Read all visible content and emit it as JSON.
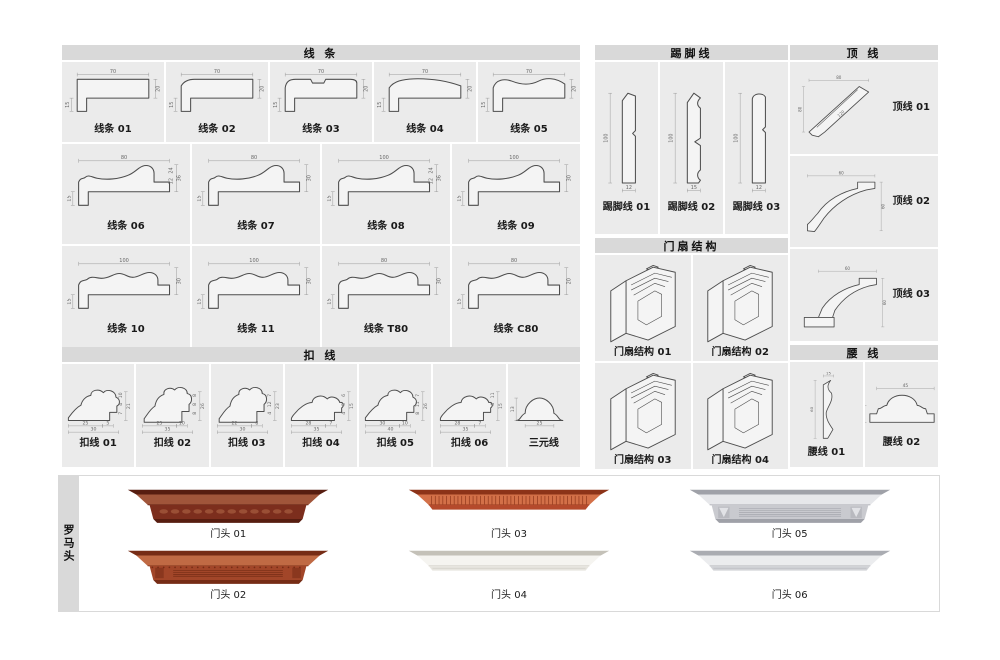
{
  "page": {
    "width": 1000,
    "height": 660,
    "background": "#ffffff"
  },
  "colors": {
    "header_bg": "#d9d9d9",
    "panel_bg": "#ebebeb",
    "profile_outline": "#4d4d4d",
    "dim_line": "#999999",
    "dim_text": "#666666",
    "label_text": "#1a1a1a"
  },
  "sections": {
    "xiantiao": {
      "title": "线  条",
      "rows": [
        {
          "items": [
            {
              "label": "线条 01",
              "shape": "flat",
              "dims": {
                "top": "70",
                "right": "20",
                "left": "15"
              }
            },
            {
              "label": "线条 02",
              "shape": "slant",
              "dims": {
                "top": "70",
                "right": "20",
                "left": "15"
              }
            },
            {
              "label": "线条 03",
              "shape": "groove",
              "dims": {
                "top": "70",
                "right": "20",
                "left": "15"
              }
            },
            {
              "label": "线条 04",
              "shape": "arch",
              "dims": {
                "top": "70",
                "right": "20",
                "left": "15"
              }
            },
            {
              "label": "线条 05",
              "shape": "wave",
              "dims": {
                "top": "70",
                "right": "20",
                "left": "15"
              }
            }
          ]
        },
        {
          "items": [
            {
              "label": "线条 06",
              "shape": "ogee",
              "dims": {
                "top": "80",
                "right": "36",
                "right_inner": [
                  "24",
                  "12"
                ],
                "left": "15"
              }
            },
            {
              "label": "线条 07",
              "shape": "ogee",
              "dims": {
                "top": "80",
                "right": "30",
                "left": "15"
              }
            },
            {
              "label": "线条 08",
              "shape": "ogee",
              "dims": {
                "top": "100",
                "right": "36",
                "right_inner": [
                  "24",
                  "12"
                ],
                "left": "15"
              }
            },
            {
              "label": "线条 09",
              "shape": "ogee",
              "dims": {
                "top": "100",
                "right": "30",
                "left": "15"
              }
            }
          ]
        },
        {
          "items": [
            {
              "label": "线条 10",
              "shape": "wave2",
              "dims": {
                "top": "100",
                "right": "30",
                "left": "15"
              }
            },
            {
              "label": "线条 11",
              "shape": "wave2",
              "dims": {
                "top": "100",
                "right": "30",
                "left": "15"
              }
            },
            {
              "label": "线条 T80",
              "shape": "wave2",
              "dims": {
                "top": "80",
                "right": "30",
                "left": "15"
              }
            },
            {
              "label": "线条 C80",
              "shape": "wave2",
              "dims": {
                "top": "80",
                "right": "20",
                "left": "15"
              }
            }
          ]
        }
      ]
    },
    "kouxian": {
      "title": "扣  线",
      "items": [
        {
          "label": "扣线 01",
          "shape": "scroll",
          "dims": {
            "bottom": "25",
            "bottom2": "5",
            "bottom_total": "30",
            "right_stack": [
              "10",
              "4",
              "7"
            ],
            "right_total": "21"
          }
        },
        {
          "label": "扣线 02",
          "shape": "scroll2",
          "dims": {
            "bottom": "25",
            "bottom2": "10",
            "bottom_total": "35",
            "right_stack": [
              "8",
              "8",
              "8"
            ],
            "right_total": "26"
          }
        },
        {
          "label": "扣线 03",
          "shape": "scroll2",
          "dims": {
            "bottom": "22",
            "bottom2": "8",
            "bottom_total": "30",
            "right_stack": [
              "7",
              "12",
              "4"
            ],
            "right_total": "23"
          }
        },
        {
          "label": "扣线 04",
          "shape": "scroll3",
          "dims": {
            "bottom": "28",
            "bottom2": "7",
            "bottom_total": "35",
            "right_stack": [
              "6",
              "5",
              "4"
            ],
            "right_total": "15"
          }
        },
        {
          "label": "扣线 05",
          "shape": "scroll",
          "dims": {
            "bottom": "30",
            "bottom2": "10",
            "bottom_total": "40",
            "right_stack": [
              "7",
              "11",
              "8"
            ],
            "right_total": "26"
          }
        },
        {
          "label": "扣线 06",
          "shape": "scroll3",
          "dims": {
            "bottom": "28",
            "bottom2": "7",
            "bottom_total": "35",
            "right_stack": [
              "11",
              "4"
            ],
            "right_total": "15"
          }
        },
        {
          "label": "三元线",
          "shape": "dome",
          "dims": {
            "left": "13",
            "bottom": "25"
          }
        }
      ]
    },
    "tijiaoxian": {
      "title": "踢脚线",
      "items": [
        {
          "label": "踢脚线 01",
          "shape": "skirt1",
          "dims": {
            "left": "100",
            "bottom": "12"
          }
        },
        {
          "label": "踢脚线 02",
          "shape": "skirt2",
          "dims": {
            "left": "100",
            "bottom": "15"
          }
        },
        {
          "label": "踢脚线 03",
          "shape": "skirt3",
          "dims": {
            "left": "100",
            "bottom": "12"
          }
        }
      ]
    },
    "menshan": {
      "title": "门扇结构",
      "items": [
        {
          "label": "门扇结构 01"
        },
        {
          "label": "门扇结构 02"
        },
        {
          "label": "门扇结构 03"
        },
        {
          "label": "门扇结构 04"
        }
      ]
    },
    "dingxian": {
      "title": "顶  线",
      "items": [
        {
          "label": "顶线 01",
          "shape": "crown1",
          "dims": {
            "top": "80",
            "left": "80",
            "diag": "120"
          }
        },
        {
          "label": "顶线 02",
          "shape": "crown2",
          "dims": {
            "top": "60",
            "right": "60"
          }
        },
        {
          "label": "顶线 03",
          "shape": "crown3",
          "dims": {
            "top": "60",
            "right": "60"
          }
        }
      ]
    },
    "yaoxian": {
      "title": "腰  线",
      "items": [
        {
          "label": "腰线 01",
          "shape": "waist1",
          "dims": {
            "top": "15",
            "left": "60"
          }
        },
        {
          "label": "腰线 02",
          "shape": "waist2",
          "dims": {
            "top": "45",
            "left": "20"
          }
        }
      ]
    },
    "luomatou": {
      "title": "罗马头",
      "columns": [
        {
          "items": [
            {
              "label": "门头 01",
              "style": "carved",
              "colors": {
                "main": "#7c2e1d",
                "dark": "#571d10",
                "light": "#a0553a"
              }
            },
            {
              "label": "门头 02",
              "style": "rosette",
              "colors": {
                "main": "#a24629",
                "dark": "#762c15",
                "light": "#c06a44"
              }
            }
          ]
        },
        {
          "items": [
            {
              "label": "门头 03",
              "style": "fluted",
              "colors": {
                "main": "#b54a2c",
                "dark": "#8c3318",
                "light": "#d37048"
              }
            },
            {
              "label": "门头 04",
              "style": "plain",
              "colors": {
                "main": "#e7e5df",
                "dark": "#c4c1b8",
                "light": "#f5f4f0"
              }
            }
          ]
        },
        {
          "items": [
            {
              "label": "门头 05",
              "style": "reed",
              "colors": {
                "main": "#c9cacf",
                "dark": "#9fa1a8",
                "light": "#e6e7ea"
              }
            },
            {
              "label": "门头 06",
              "style": "plain",
              "colors": {
                "main": "#d2d3d7",
                "dark": "#aaacb2",
                "light": "#ebecee"
              }
            }
          ]
        }
      ]
    }
  }
}
